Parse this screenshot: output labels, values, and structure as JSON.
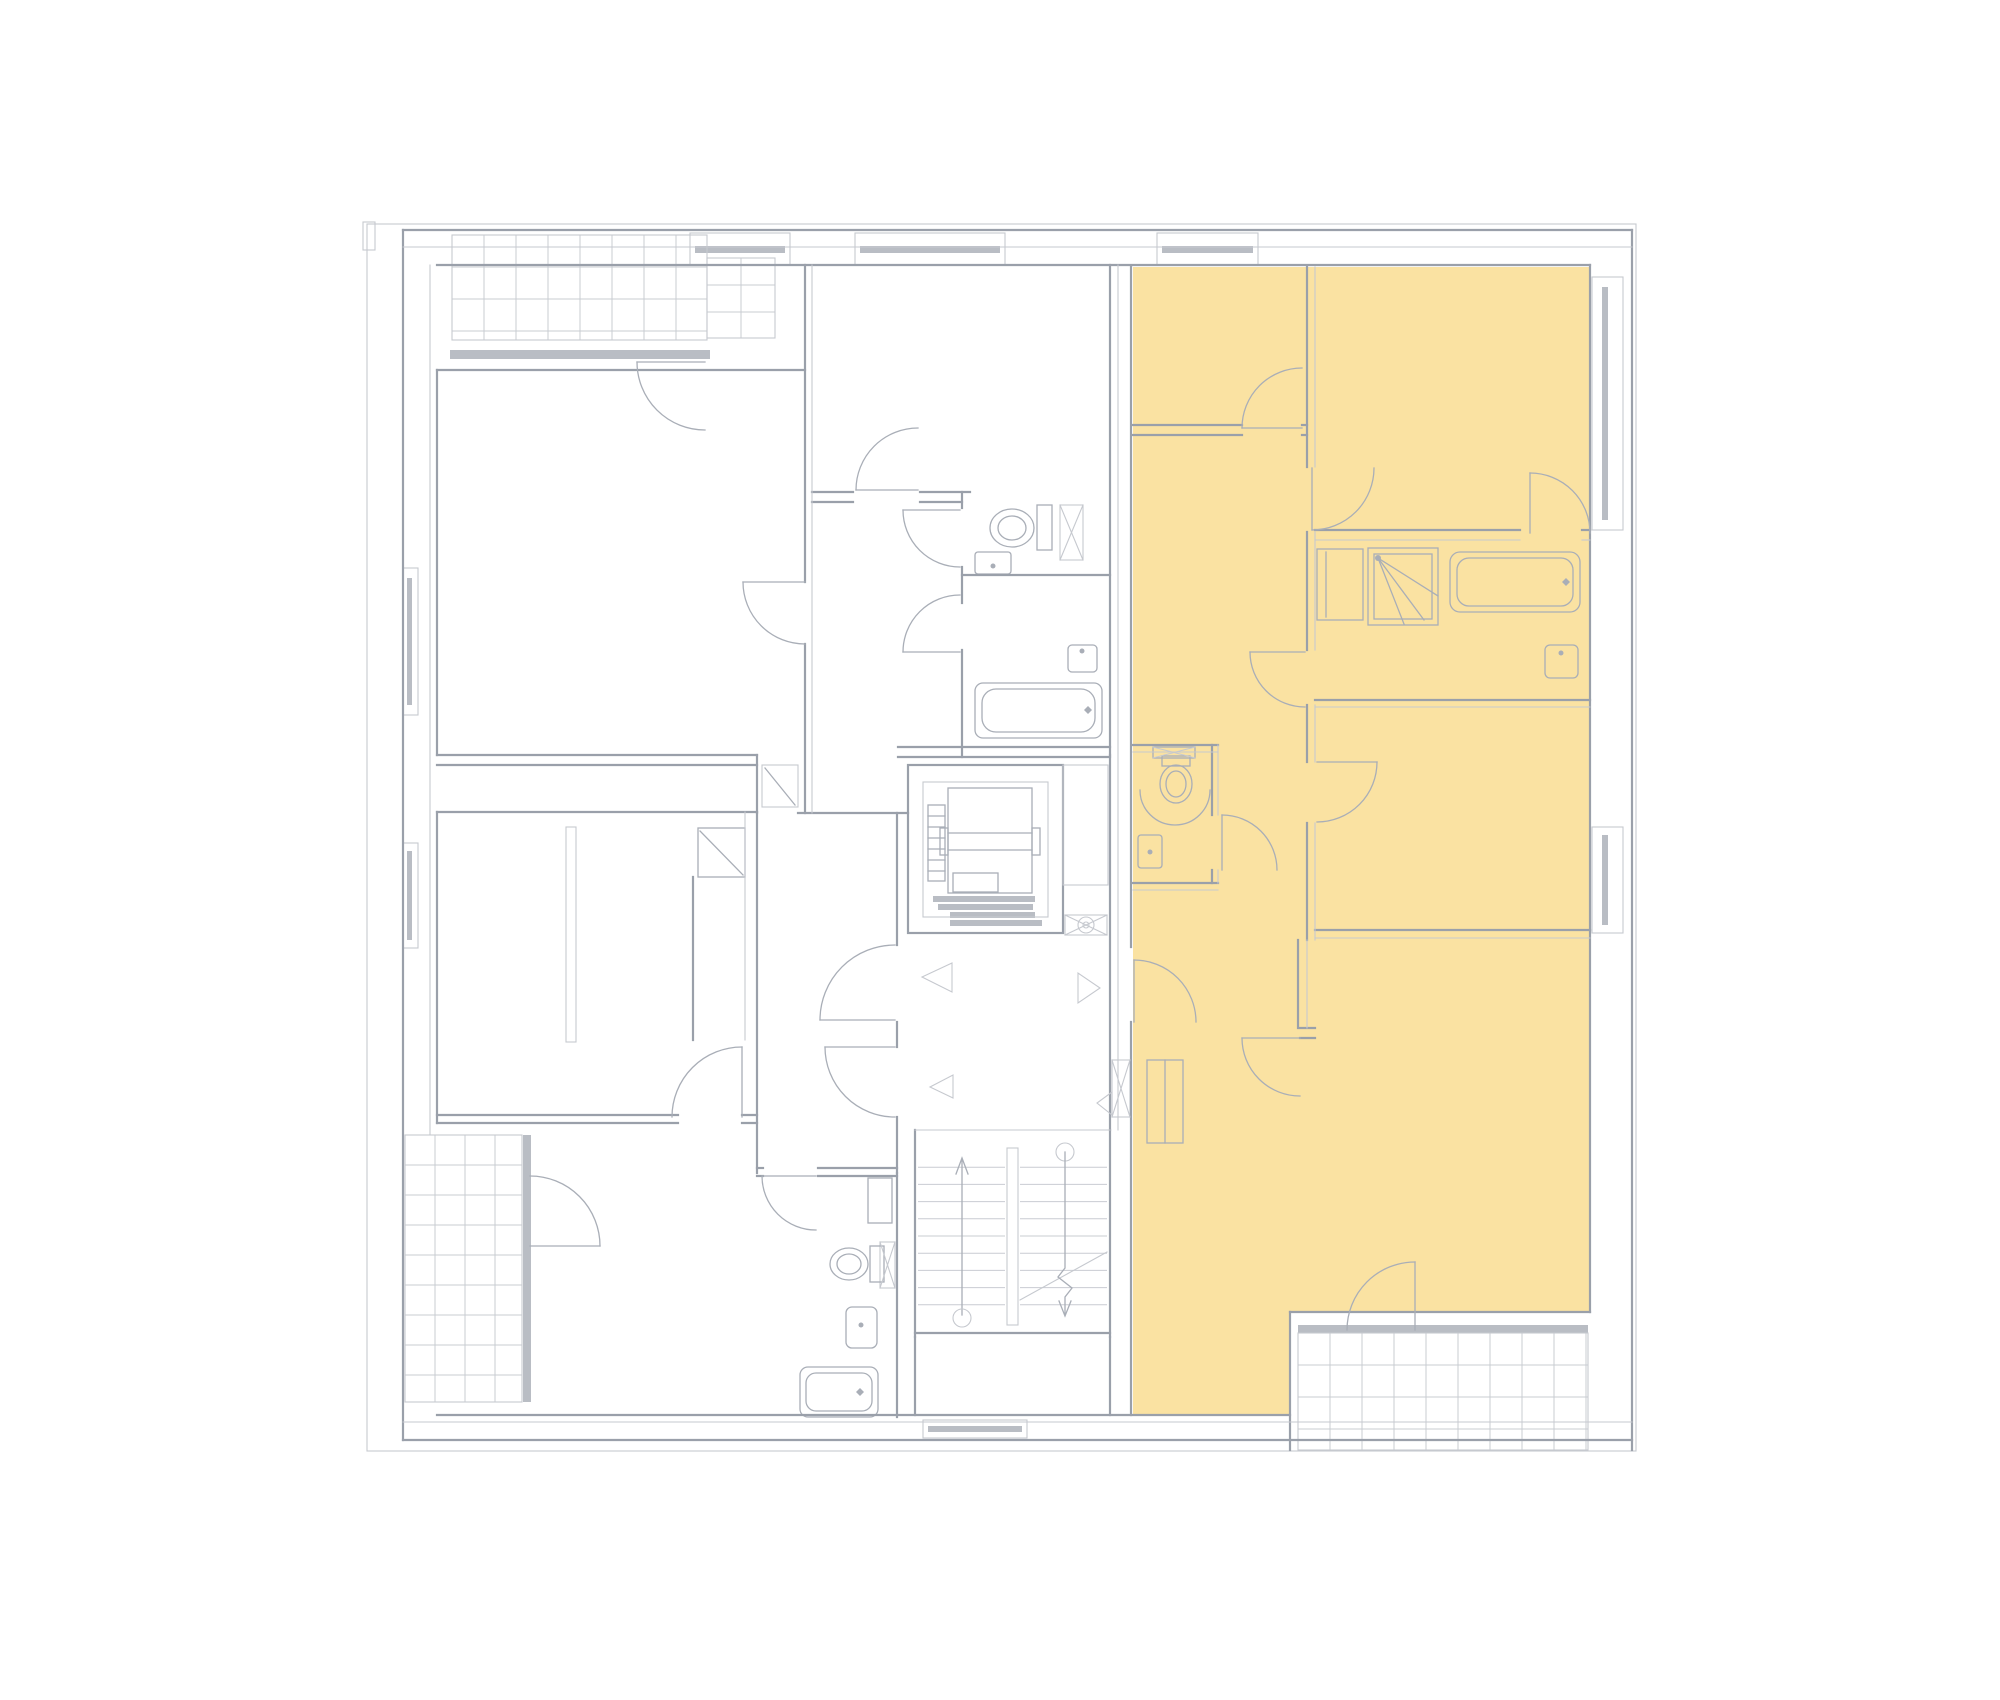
{
  "meta": {
    "page_type": "floor-plan-viewer",
    "visible_text": [],
    "highlighted_units_count": 1
  },
  "canvas": {
    "w": 2000,
    "h": 1700,
    "bg": "#ffffff"
  },
  "colors": {
    "highlight": "#FAE2A2",
    "wall": "#9aa0aa",
    "light": "#c6c9cf",
    "fixture": "#a9aeb7",
    "glazing": "#b9bdc4",
    "white": "#ffffff"
  },
  "highlight": {
    "name": "highlighted-unit",
    "points": "1133,267 1590,267 1590,1312 1290,1312 1290,1415 1133,1415"
  },
  "grids": [
    {
      "x": 452,
      "y": 235,
      "w": 255,
      "h": 105,
      "dx": 32,
      "dy": 32
    },
    {
      "x": 707,
      "y": 258,
      "w": 68,
      "h": 80,
      "dx": 34,
      "dy": 27
    },
    {
      "x": 405,
      "y": 1135,
      "w": 117,
      "h": 267,
      "dx": 30,
      "dy": 30
    },
    {
      "x": 1298,
      "y": 1333,
      "w": 290,
      "h": 117,
      "dx": 32,
      "dy": 32
    },
    {
      "x": 918,
      "y": 1150,
      "w": 87,
      "h": 172,
      "dx": 0,
      "dy": 17.2
    },
    {
      "x": 1020,
      "y": 1150,
      "w": 87,
      "h": 172,
      "dx": 0,
      "dy": 17.2
    }
  ],
  "glazing": [
    [
      695,
      246,
      90,
      7
    ],
    [
      860,
      246,
      140,
      7
    ],
    [
      1162,
      246,
      91,
      7
    ],
    [
      1602,
      287,
      6,
      233
    ],
    [
      1602,
      835,
      6,
      90
    ],
    [
      407,
      578,
      5,
      127
    ],
    [
      407,
      851,
      5,
      89
    ],
    [
      928,
      1426,
      94,
      6
    ],
    [
      450,
      350,
      260,
      9
    ],
    [
      523,
      1135,
      8,
      267
    ],
    [
      1298,
      1325,
      290,
      8
    ],
    [
      933,
      896,
      102,
      6
    ],
    [
      938,
      904,
      95,
      6
    ],
    [
      950,
      912,
      85,
      6
    ],
    [
      950,
      920,
      92,
      6
    ]
  ],
  "squares": [
    [
      446,
      347,
      9,
      9
    ],
    [
      573,
      347,
      9,
      9
    ],
    [
      701,
      347,
      9,
      9
    ],
    [
      519,
      1131,
      9,
      9
    ],
    [
      519,
      1243,
      9,
      9
    ],
    [
      519,
      1396,
      9,
      9
    ],
    [
      1294,
      1322,
      9,
      9
    ],
    [
      1438,
      1322,
      9,
      9
    ],
    [
      1583,
      1322,
      9,
      9
    ],
    [
      857,
      243,
      8,
      8
    ],
    [
      998,
      243,
      8,
      8
    ],
    [
      1598,
      273,
      8,
      8
    ],
    [
      1598,
      526,
      8,
      8
    ],
    [
      1598,
      823,
      8,
      8
    ],
    [
      1598,
      929,
      8,
      8
    ],
    [
      919,
      1424,
      8,
      8
    ],
    [
      1023,
      1424,
      8,
      8
    ]
  ],
  "rects": [
    [
      367,
      224,
      1269,
      1227,
      "t",
      0,
      "site-outline"
    ],
    [
      363,
      222,
      12,
      28,
      "t",
      0,
      "facade-notch"
    ],
    [
      908,
      765,
      155,
      168,
      "w",
      0,
      "elevator-shaft"
    ],
    [
      923,
      782,
      125,
      135,
      "t",
      0,
      "elevator-shaft-inner"
    ],
    [
      948,
      788,
      84,
      105,
      "f",
      0,
      "elevator-cab"
    ],
    [
      940,
      828,
      8,
      27,
      "f",
      0,
      "elevator-guide-left"
    ],
    [
      1032,
      828,
      8,
      27,
      "f",
      0,
      "elevator-guide-right"
    ],
    [
      928,
      805,
      17,
      76,
      "f",
      0,
      "elevator-counterweight"
    ],
    [
      953,
      873,
      45,
      19,
      "f",
      0,
      "elevator-cab-box"
    ],
    [
      1063,
      765,
      45,
      120,
      "t",
      0,
      "vent-duct"
    ],
    [
      1065,
      915,
      42,
      20,
      "t",
      0,
      "fan-box"
    ],
    [
      1112,
      1060,
      18,
      57,
      "t",
      0,
      "shaft-landing"
    ],
    [
      1007,
      1148,
      11,
      177,
      "t",
      0,
      "stair-rail"
    ],
    [
      762,
      765,
      36,
      42,
      "t",
      0,
      "niche-apt1"
    ],
    [
      698,
      828,
      47,
      49,
      "f",
      0,
      "closet-apt1"
    ],
    [
      566,
      827,
      10,
      215,
      "t",
      0,
      "partition-stub"
    ],
    [
      1037,
      505,
      15,
      45,
      "f",
      0,
      "toilet-tank-apt1"
    ],
    [
      1060,
      505,
      23,
      55,
      "t",
      0,
      "shaft-wc-apt1"
    ],
    [
      975,
      552,
      36,
      22,
      "f",
      3,
      "sink-wc-apt1"
    ],
    [
      975,
      683,
      127,
      55,
      "f",
      8,
      "bathtub-apt1"
    ],
    [
      982,
      689,
      113,
      43,
      "f",
      14,
      "bathtub-apt1-inner"
    ],
    [
      1068,
      645,
      29,
      27,
      "f",
      4,
      "sink-bath-apt1"
    ],
    [
      868,
      1178,
      24,
      45,
      "f",
      0,
      "cabinet-apt2"
    ],
    [
      880,
      1242,
      15,
      46,
      "t",
      0,
      "shaft-apt2"
    ],
    [
      870,
      1246,
      14,
      36,
      "f",
      0,
      "toilet-tank-apt2"
    ],
    [
      846,
      1307,
      31,
      41,
      "f",
      6,
      "sink-apt2"
    ],
    [
      800,
      1367,
      78,
      50,
      "f",
      8,
      "bathtub-apt2"
    ],
    [
      806,
      1373,
      66,
      38,
      "f",
      10,
      "bathtub-apt2-inner"
    ],
    [
      1153,
      747,
      42,
      11,
      "f",
      0,
      "vanity-wc-unit"
    ],
    [
      1162,
      756,
      28,
      10,
      "f",
      0,
      "toilet-tank-unit"
    ],
    [
      1138,
      835,
      24,
      33,
      "f",
      3,
      "sink-wc-unit"
    ],
    [
      1317,
      549,
      46,
      71,
      "f",
      0,
      "closet-unit-bath"
    ],
    [
      1368,
      548,
      70,
      77,
      "f",
      0,
      "shower-unit"
    ],
    [
      1374,
      554,
      58,
      65,
      "f",
      0,
      "shower-unit-inner"
    ],
    [
      1450,
      552,
      130,
      60,
      "f",
      10,
      "bathtub-unit"
    ],
    [
      1457,
      558,
      116,
      48,
      "f",
      12,
      "bathtub-unit-inner"
    ],
    [
      1545,
      645,
      33,
      33,
      "f",
      5,
      "sink-bath-unit"
    ],
    [
      1147,
      1060,
      36,
      83,
      "f",
      0,
      "entry-closet-unit"
    ],
    [
      452,
      235,
      255,
      105,
      "t",
      0,
      "balcony-top-left"
    ],
    [
      707,
      258,
      68,
      80,
      "t",
      0,
      "balcony-top-left-ext"
    ],
    [
      405,
      1135,
      117,
      267,
      "t",
      0,
      "balcony-bottom-left"
    ],
    [
      1298,
      1333,
      290,
      117,
      "t",
      0,
      "balcony-bottom-right"
    ],
    [
      690,
      233,
      100,
      32,
      "t",
      0,
      "window-top-1"
    ],
    [
      855,
      233,
      150,
      32,
      "t",
      0,
      "window-top-2"
    ],
    [
      1157,
      233,
      101,
      32,
      "t",
      0,
      "window-top-3"
    ],
    [
      1592,
      277,
      31,
      253,
      "t",
      0,
      "window-right-1"
    ],
    [
      1592,
      827,
      31,
      106,
      "t",
      0,
      "window-right-2"
    ],
    [
      403,
      568,
      15,
      147,
      "t",
      0,
      "window-left-1"
    ],
    [
      403,
      843,
      15,
      105,
      "t",
      0,
      "window-left-2"
    ],
    [
      923,
      1420,
      104,
      18,
      "t",
      0,
      "window-bottom-1"
    ]
  ],
  "walls": [
    [
      403,
      230,
      1632,
      230
    ],
    [
      403,
      230,
      403,
      1440
    ],
    [
      1632,
      230,
      1632,
      1450
    ],
    [
      403,
      1440,
      1632,
      1440
    ],
    [
      437,
      265,
      1590,
      265
    ],
    [
      1590,
      265,
      1590,
      1312
    ],
    [
      437,
      1415,
      1290,
      1415
    ],
    [
      437,
      370,
      437,
      755
    ],
    [
      437,
      812,
      437,
      1123
    ],
    [
      437,
      370,
      805,
      370
    ],
    [
      805,
      265,
      805,
      582
    ],
    [
      805,
      644,
      805,
      813
    ],
    [
      437,
      755,
      757,
      755
    ],
    [
      437,
      765,
      757,
      765
    ],
    [
      757,
      755,
      757,
      813
    ],
    [
      798,
      813,
      908,
      813
    ],
    [
      437,
      812,
      757,
      812
    ],
    [
      757,
      812,
      757,
      1173
    ],
    [
      437,
      1115,
      678,
      1115
    ],
    [
      742,
      1115,
      757,
      1115
    ],
    [
      437,
      1123,
      678,
      1123
    ],
    [
      742,
      1123,
      757,
      1123
    ],
    [
      693,
      877,
      693,
      1040
    ],
    [
      897,
      813,
      897,
      945
    ],
    [
      897,
      1022,
      897,
      1047
    ],
    [
      897,
      1117,
      897,
      1173
    ],
    [
      897,
      1173,
      897,
      1417
    ],
    [
      757,
      1168,
      763,
      1168
    ],
    [
      818,
      1168,
      897,
      1168
    ],
    [
      757,
      1176,
      763,
      1176
    ],
    [
      818,
      1176,
      897,
      1176
    ],
    [
      812,
      492,
      853,
      492
    ],
    [
      920,
      492,
      970,
      492
    ],
    [
      812,
      502,
      853,
      502
    ],
    [
      920,
      502,
      962,
      502
    ],
    [
      962,
      492,
      962,
      508
    ],
    [
      962,
      567,
      962,
      603
    ],
    [
      962,
      650,
      962,
      757
    ],
    [
      962,
      575,
      1110,
      575
    ],
    [
      898,
      747,
      1110,
      747
    ],
    [
      898,
      757,
      1110,
      757
    ],
    [
      1110,
      265,
      1110,
      755
    ],
    [
      1110,
      755,
      1110,
      1130
    ],
    [
      1110,
      1130,
      1110,
      1337
    ],
    [
      1110,
      1337,
      1110,
      1415
    ],
    [
      1131,
      267,
      1131,
      947
    ],
    [
      1131,
      1022,
      1131,
      1415
    ],
    [
      915,
      1130,
      915,
      1337
    ],
    [
      915,
      1333,
      1110,
      1333
    ],
    [
      915,
      1337,
      915,
      1415
    ],
    [
      1307,
      267,
      1307,
      467
    ],
    [
      1307,
      532,
      1307,
      650
    ],
    [
      1307,
      705,
      1307,
      762
    ],
    [
      1307,
      823,
      1307,
      940
    ],
    [
      1133,
      425,
      1242,
      425
    ],
    [
      1302,
      425,
      1307,
      425
    ],
    [
      1133,
      435,
      1242,
      435
    ],
    [
      1302,
      435,
      1307,
      435
    ],
    [
      1315,
      530,
      1520,
      530
    ],
    [
      1582,
      530,
      1590,
      530
    ],
    [
      1315,
      700,
      1590,
      700
    ],
    [
      1315,
      930,
      1590,
      930
    ],
    [
      1298,
      940,
      1298,
      1028
    ],
    [
      1300,
      1028,
      1315,
      1028
    ],
    [
      1300,
      1038,
      1315,
      1038
    ],
    [
      1133,
      745,
      1218,
      745
    ],
    [
      1133,
      883,
      1218,
      883
    ],
    [
      1212,
      745,
      1212,
      815
    ],
    [
      1212,
      870,
      1212,
      883
    ],
    [
      1290,
      1312,
      1290,
      1450
    ],
    [
      1290,
      1312,
      1590,
      1312
    ]
  ],
  "thin": [
    [
      430,
      265,
      430,
      1135
    ],
    [
      812,
      265,
      812,
      813
    ],
    [
      1118,
      265,
      1118,
      1130
    ],
    [
      1315,
      267,
      1315,
      467
    ],
    [
      1315,
      532,
      1315,
      650
    ],
    [
      1315,
      705,
      1315,
      762
    ],
    [
      1315,
      823,
      1315,
      940
    ],
    [
      1315,
      540,
      1520,
      540
    ],
    [
      1582,
      540,
      1590,
      540
    ],
    [
      1315,
      707,
      1590,
      707
    ],
    [
      1315,
      938,
      1590,
      938
    ],
    [
      1218,
      745,
      1218,
      815
    ],
    [
      1218,
      870,
      1218,
      883
    ],
    [
      1133,
      752,
      1218,
      752
    ],
    [
      1133,
      890,
      1218,
      890
    ],
    [
      745,
      812,
      745,
      1040
    ],
    [
      403,
      247,
      1632,
      247
    ],
    [
      915,
      1130,
      1110,
      1130
    ],
    [
      403,
      1422,
      1632,
      1422
    ],
    [
      1307,
      940,
      1307,
      1028
    ],
    [
      1060,
      505,
      1083,
      560
    ],
    [
      1083,
      505,
      1060,
      560
    ],
    [
      1112,
      1060,
      1130,
      1117
    ],
    [
      1130,
      1060,
      1112,
      1117
    ],
    [
      880,
      1242,
      895,
      1288
    ],
    [
      895,
      1242,
      880,
      1288
    ],
    [
      1153,
      747,
      1195,
      758
    ],
    [
      1195,
      747,
      1153,
      758
    ],
    [
      1065,
      915,
      1107,
      935
    ],
    [
      1107,
      915,
      1065,
      935
    ],
    [
      1020,
      1300,
      1107,
      1252
    ]
  ],
  "fittings": [
    [
      705,
      362,
      637,
      362
    ],
    [
      805,
      582,
      743,
      582
    ],
    [
      918,
      490,
      856,
      490
    ],
    [
      960,
      510,
      903,
      510
    ],
    [
      960,
      652,
      903,
      652
    ],
    [
      895,
      1020,
      820,
      1020
    ],
    [
      895,
      1047,
      825,
      1047
    ],
    [
      742,
      1117,
      742,
      1047
    ],
    [
      816,
      1176,
      762,
      1176
    ],
    [
      530,
      1246,
      600,
      1246
    ],
    [
      1134,
      1022,
      1134,
      960
    ],
    [
      1302,
      428,
      1242,
      428
    ],
    [
      1312,
      468,
      1312,
      530
    ],
    [
      1305,
      652,
      1250,
      652
    ],
    [
      1317,
      762,
      1377,
      762
    ],
    [
      1222,
      870,
      1222,
      815
    ],
    [
      1300,
      1038,
      1242,
      1038
    ],
    [
      1415,
      1330,
      1415,
      1262
    ],
    [
      1530,
      533,
      1530,
      473
    ],
    [
      700,
      831,
      743,
      875
    ],
    [
      765,
      768,
      795,
      805
    ],
    [
      1326,
      552,
      1326,
      617
    ],
    [
      1165,
      1060,
      1165,
      1143
    ],
    [
      1378,
      558,
      1438,
      596
    ],
    [
      1378,
      558,
      1424,
      620
    ],
    [
      1378,
      558,
      1404,
      624
    ],
    [
      948,
      833,
      1032,
      833
    ],
    [
      948,
      850,
      1032,
      850
    ],
    [
      928,
      816,
      945,
      816
    ],
    [
      928,
      827,
      945,
      827
    ],
    [
      928,
      838,
      945,
      838
    ],
    [
      928,
      849,
      945,
      849
    ],
    [
      928,
      860,
      945,
      860
    ],
    [
      928,
      871,
      945,
      871
    ],
    [
      962,
      1160,
      962,
      1315
    ]
  ],
  "arcs": [
    [
      705,
      362,
      68,
      180,
      90
    ],
    [
      805,
      582,
      62,
      180,
      90
    ],
    [
      918,
      490,
      62,
      180,
      270
    ],
    [
      960,
      510,
      57,
      180,
      90
    ],
    [
      960,
      652,
      57,
      180,
      270
    ],
    [
      895,
      1020,
      75,
      180,
      270
    ],
    [
      895,
      1047,
      70,
      180,
      90
    ],
    [
      742,
      1117,
      70,
      270,
      180
    ],
    [
      816,
      1176,
      54,
      180,
      90
    ],
    [
      530,
      1246,
      70,
      270,
      0
    ],
    [
      1134,
      1022,
      62,
      270,
      0
    ],
    [
      1302,
      428,
      60,
      180,
      270
    ],
    [
      1312,
      468,
      62,
      90,
      0
    ],
    [
      1305,
      652,
      55,
      180,
      90
    ],
    [
      1317,
      762,
      60,
      0,
      90
    ],
    [
      1222,
      870,
      55,
      270,
      0
    ],
    [
      1300,
      1038,
      58,
      180,
      90
    ],
    [
      1415,
      1330,
      68,
      270,
      180
    ],
    [
      1530,
      533,
      60,
      270,
      0
    ],
    [
      1175,
      790,
      35,
      0,
      180
    ]
  ],
  "ellipses": [
    [
      1012,
      528,
      22,
      19,
      "toilet-apt1"
    ],
    [
      1012,
      528,
      14,
      12,
      ""
    ],
    [
      849,
      1264,
      19,
      16,
      "toilet-apt2"
    ],
    [
      849,
      1264,
      12,
      10,
      ""
    ],
    [
      1176,
      784,
      16,
      19,
      "toilet-unit"
    ],
    [
      1176,
      784,
      10,
      13,
      ""
    ]
  ],
  "circles": [
    [
      962,
      1318,
      9
    ],
    [
      1065,
      1152,
      9
    ],
    [
      1086,
      925,
      8
    ],
    [
      1086,
      925,
      3
    ]
  ],
  "dots": [
    [
      993,
      566,
      2.5
    ],
    [
      1082,
      651,
      2.5
    ],
    [
      861,
      1325,
      2.5
    ],
    [
      1150,
      852,
      2.5
    ],
    [
      1561,
      653,
      2.5
    ],
    [
      1378,
      558,
      3
    ]
  ],
  "diamonds": [
    [
      1088,
      710
    ],
    [
      860,
      1392
    ],
    [
      1566,
      582
    ]
  ],
  "polygons": [
    {
      "points": "952,963 952,992 922,977",
      "f": "white",
      "n": "door-direction-triangle-1"
    },
    {
      "points": "953,1075 953,1098 930,1087",
      "f": "white",
      "n": "door-direction-triangle-2"
    },
    {
      "points": "1078,973 1078,1003 1100,988",
      "f": "white",
      "n": "door-direction-triangle-3"
    },
    {
      "points": "1112,1092 1112,1115 1097,1103",
      "f": "fix",
      "n": "door-direction-triangle-4"
    }
  ],
  "plines": [
    {
      "points": "956,1174 962,1158 968,1174",
      "n": "stairs-up-arrowhead"
    },
    {
      "points": "1059,1301 1065,1316 1071,1301",
      "n": "stairs-down-arrowhead"
    },
    {
      "points": "1065,1152 1065,1268 1058,1277 1072,1288 1065,1297 1065,1314",
      "n": "stairs-down-line"
    }
  ]
}
